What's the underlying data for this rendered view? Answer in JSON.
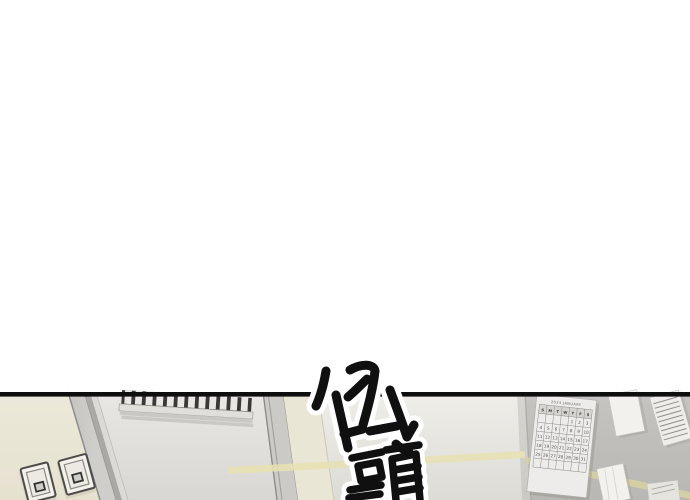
{
  "page": {
    "background": "#ffffff",
    "panel_border_color": "#0e0e0e"
  },
  "sfx": {
    "text": "低頭",
    "ink_color": "#111111",
    "outline_color": "#ffffff"
  },
  "calendar": {
    "title": "2023 JANUARY",
    "days": [
      "S",
      "M",
      "T",
      "W",
      "T",
      "F",
      "S"
    ],
    "first_day_offset": 4,
    "dates": [
      1,
      2,
      3,
      4,
      5,
      6,
      7,
      8,
      9,
      10,
      11,
      12,
      13,
      14,
      15,
      16,
      17,
      18,
      19,
      20,
      21,
      22,
      23,
      24,
      25,
      26,
      27,
      28,
      29,
      30,
      31
    ]
  },
  "colors": {
    "wall_left_cream": "#eae6d6",
    "wall_mid_gray": "#dedddা",
    "wall_right_gray": "#bfbebb",
    "accent_stripe": "#e7e0b4",
    "door_frame_gray": "#c9c8c5",
    "grille_dark": "#3a3937",
    "calendar_paper": "#edecea",
    "note_paper": "#f1f0ed"
  }
}
